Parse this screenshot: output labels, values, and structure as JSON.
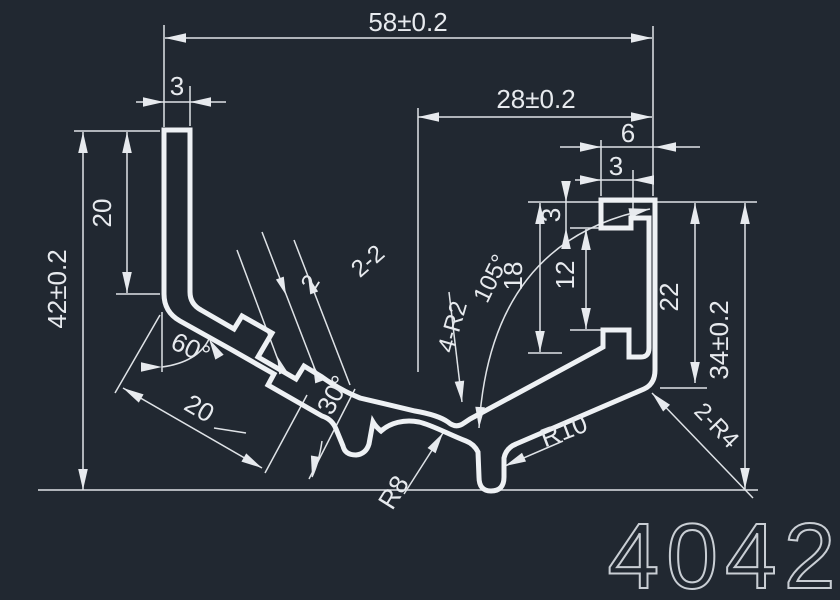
{
  "drawing": {
    "part_number": "4042",
    "background_color": "#212831",
    "line_color": "#eef1f4",
    "dimension_color": "#e7eaee"
  },
  "dims": {
    "overall_width": "58±0.2",
    "left_wall": "3",
    "right_span": "28±0.2",
    "flange_width": "6",
    "flange_lip": "3",
    "overall_height": "42±0.2",
    "left_arm": "20",
    "slope_length": "20",
    "bend_angle": "60°",
    "foot_angle": "30°",
    "vee_angle": "105°",
    "channel_depth": "18",
    "channel_opening": "12",
    "lip_height": "3",
    "flange_height": "22",
    "right_height": "34±0.2",
    "vertex_fillets": "4-R2",
    "hump_radius": "R8",
    "hook_radius": "R10",
    "wall_thickness": "2",
    "rib_thickness": "2-2",
    "corner_radius": "2-R4"
  }
}
